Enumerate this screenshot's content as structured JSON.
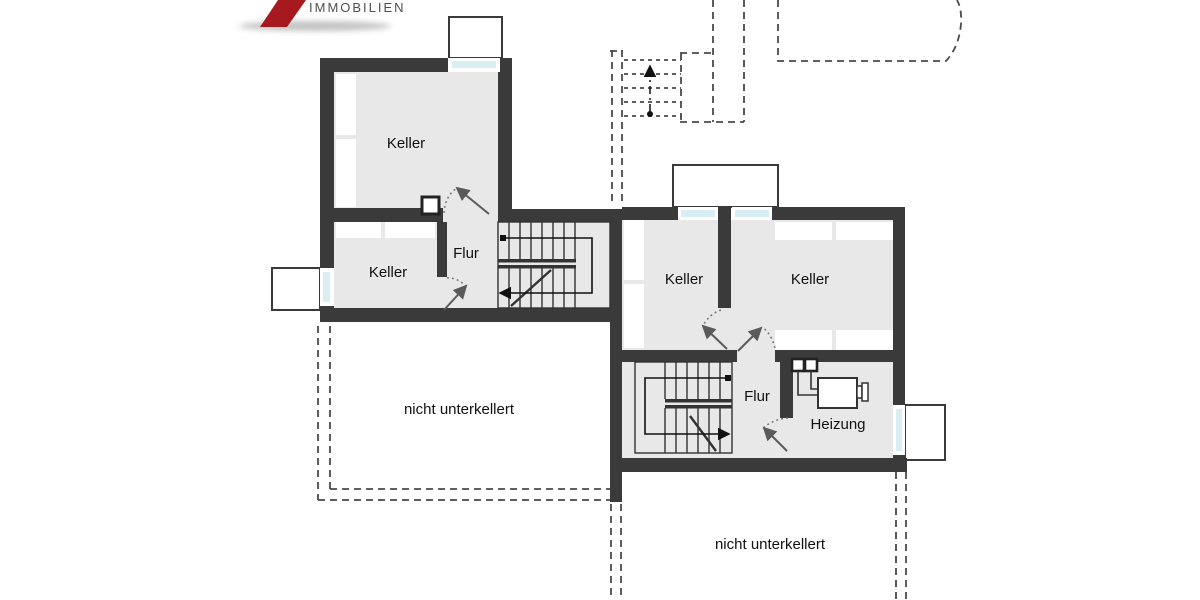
{
  "logo": {
    "brand": "IMMOBILIEN"
  },
  "rooms": {
    "keller_nw": "Keller",
    "keller_sw": "Keller",
    "flur_west": "Flur",
    "keller_mid": "Keller",
    "keller_east": "Keller",
    "flur_east": "Flur",
    "heizung": "Heizung"
  },
  "areas": {
    "no_basement_left": "nicht unterkellert",
    "no_basement_right": "nicht unterkellert"
  },
  "colors": {
    "wall": "#3a3a3a",
    "room_fill": "#e8e8e8",
    "window_glass": "#d9eef2",
    "line": "#333333",
    "dashed_line": "#4a4a4a",
    "label_text": "#111111",
    "logo_red": "#a5191f",
    "logo_text": "#4f4f4f"
  }
}
